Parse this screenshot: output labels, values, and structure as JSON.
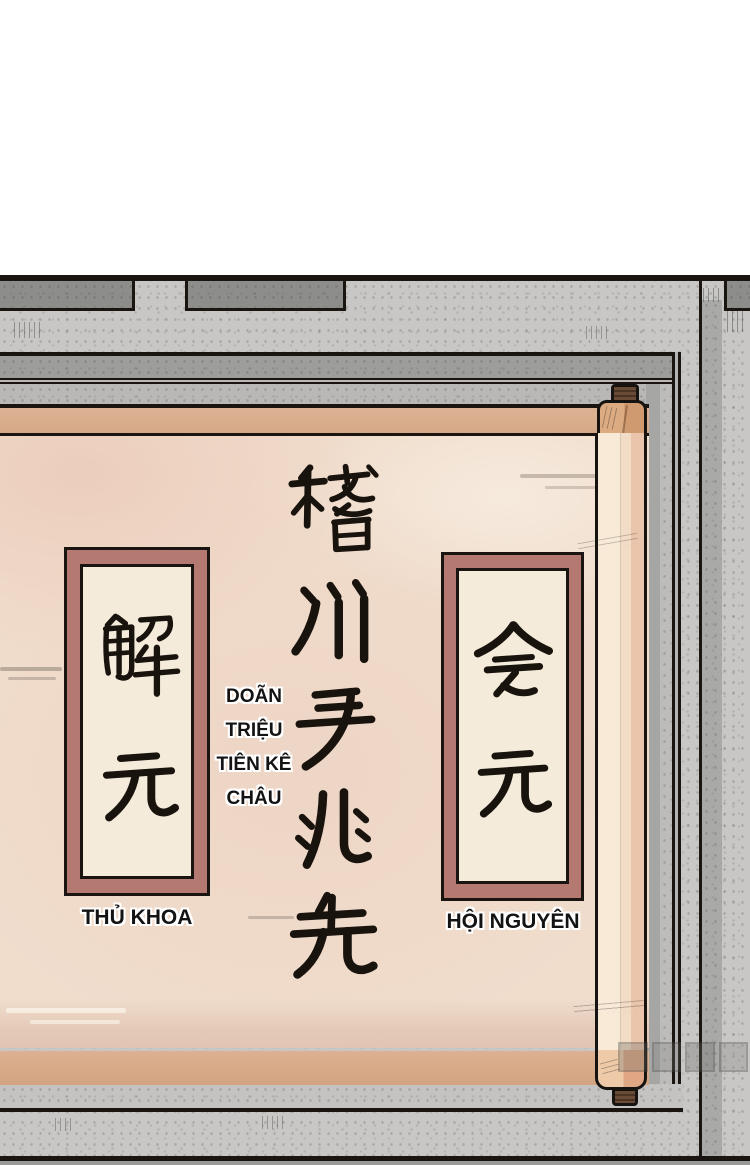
{
  "scroll": {
    "title_calligraphy": {
      "text": "稽州尹兆先",
      "chars": [
        "稽",
        "州",
        "尹",
        "兆",
        "先"
      ]
    },
    "title_translation": {
      "full": "DOÃN TRIỆU TIÊN KÊ CHÂU",
      "lines": [
        "DOÃN",
        "TRIỆU",
        "TIÊN KÊ",
        "CHÂU"
      ]
    },
    "left_plaque": {
      "calligraphy": "解元",
      "chars": [
        "解",
        "元"
      ],
      "caption": "THỦ KHOA"
    },
    "right_plaque": {
      "calligraphy": "会元",
      "chars": [
        "会",
        "元"
      ],
      "caption": "HỘI NGUYÊN"
    }
  },
  "colors": {
    "paper": "#f1e0cf",
    "paper_wash": "#ebd0c2",
    "scroll_band": "#d8ae8e",
    "plaque_frame": "#b47a72",
    "plaque_inner": "#f5ebdb",
    "roller_body": "#f7e9d6",
    "roller_cap": "#d7a37a",
    "roller_knob": "#66492f",
    "stone_light": "#c8c7c5",
    "stone_dark_block": "#8d8d8b",
    "ink": "#19130e"
  }
}
